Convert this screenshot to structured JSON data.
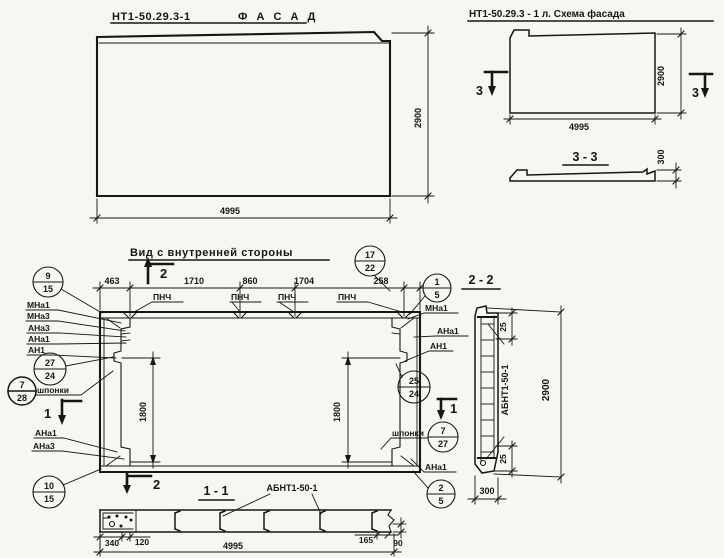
{
  "facade": {
    "code": "НТ1-50.29.3-1",
    "name": "Ф А С А Д",
    "dim_width": "4995",
    "dim_height": "2900"
  },
  "schema": {
    "title": "НТ1-50.29.3 - 1 л. Схема фасада",
    "dim_width": "4995",
    "dim_height": "2900",
    "marker": "3",
    "section_title": "3 - 3",
    "dim_thickness": "300"
  },
  "inner": {
    "title": "Вид с внутренней стороны",
    "top_dims": [
      "463",
      "1710",
      "860",
      "1704",
      "258"
    ],
    "pnch": [
      "ПНЧ",
      "ПНЧ",
      "ПНЧ",
      "ПНЧ"
    ],
    "dim_vert_left": "1800",
    "dim_vert_right": "1800",
    "marker_1": "1",
    "marker_2": "2",
    "shponki_left": "шпонки",
    "shponki_right": "шпонки",
    "labels_left": [
      "МНа1",
      "МНа3",
      "АНа3",
      "АНа1",
      "АН1"
    ],
    "labels_left_bottom": [
      "АНа1",
      "АНа3"
    ],
    "labels_right": [
      "МНа1",
      "АНа1",
      "АН1",
      "АНа1"
    ],
    "balloons": {
      "b17_22": {
        "top": "17",
        "bot": "22"
      },
      "b9_15": {
        "top": "9",
        "bot": "15"
      },
      "b1_5": {
        "top": "1",
        "bot": "5"
      },
      "b27_24": {
        "top": "27",
        "bot": "24"
      },
      "b7_28": {
        "top": "7",
        "bot": "28"
      },
      "b25_24": {
        "top": "25",
        "bot": "24"
      },
      "b7_27": {
        "top": "7",
        "bot": "27"
      },
      "b10_15": {
        "top": "10",
        "bot": "15"
      },
      "b2_5": {
        "top": "2",
        "bot": "5"
      }
    }
  },
  "sec22": {
    "title": "2 - 2",
    "dim_top": "25",
    "dim_bot": "25",
    "dim_height": "2900",
    "dim_width": "300",
    "label": "АБНТ1-50-1"
  },
  "sec11": {
    "title": "1 - 1",
    "label": "АБНТ1-50-1",
    "dim_340": "340",
    "dim_120": "120",
    "dim_165": "165",
    "dim_90": "90",
    "dim_total": "4995"
  }
}
